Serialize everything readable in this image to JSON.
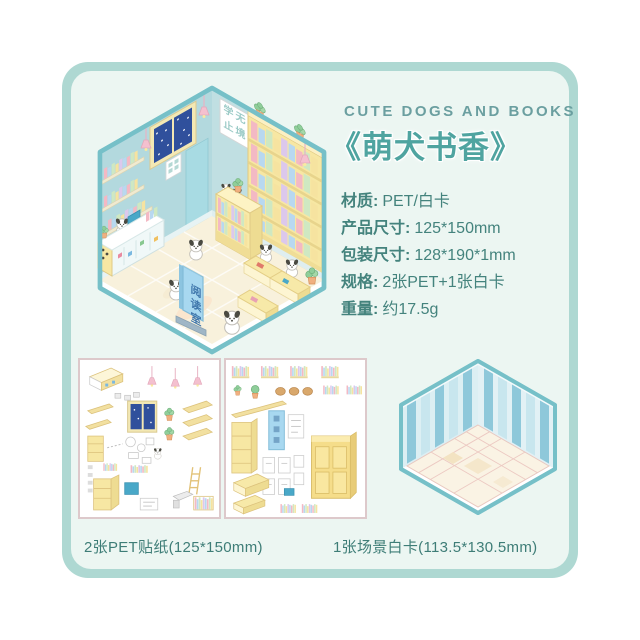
{
  "header": {
    "title_en": "CUTE DOGS AND BOOKS",
    "title_cn": "《萌犬书香》"
  },
  "specs": [
    {
      "label": "材质:",
      "value": "PET/白卡"
    },
    {
      "label": "产品尺寸:",
      "value": "125*150mm"
    },
    {
      "label": "包装尺寸:",
      "value": "128*190*1mm"
    },
    {
      "label": "规格:",
      "value": "2张PET+1张白卡"
    },
    {
      "label": "重量:",
      "value": "约17.5g"
    }
  ],
  "room": {
    "sign_text": "阅读室",
    "poster_line1": "学无",
    "poster_line2": "止境"
  },
  "captions": {
    "stickers": "2张PET贴纸(125*150mm)",
    "scene_card": "1张场景白卡(113.5*130.5mm)"
  },
  "colors": {
    "frame": "#aed8d2",
    "panel": "#ecf6f2",
    "accent_teal": "#4fa4a0",
    "text": "#44837d",
    "room_outline": "#76c0c8",
    "wall_blue": "#b5dade",
    "shelf_yellow": "#f7e7a3",
    "window_navy": "#30509c",
    "sign_blue": "#a8d8f0",
    "lamp_pink": "#f4c0cf",
    "floor_cream": "#f8f1dc"
  }
}
